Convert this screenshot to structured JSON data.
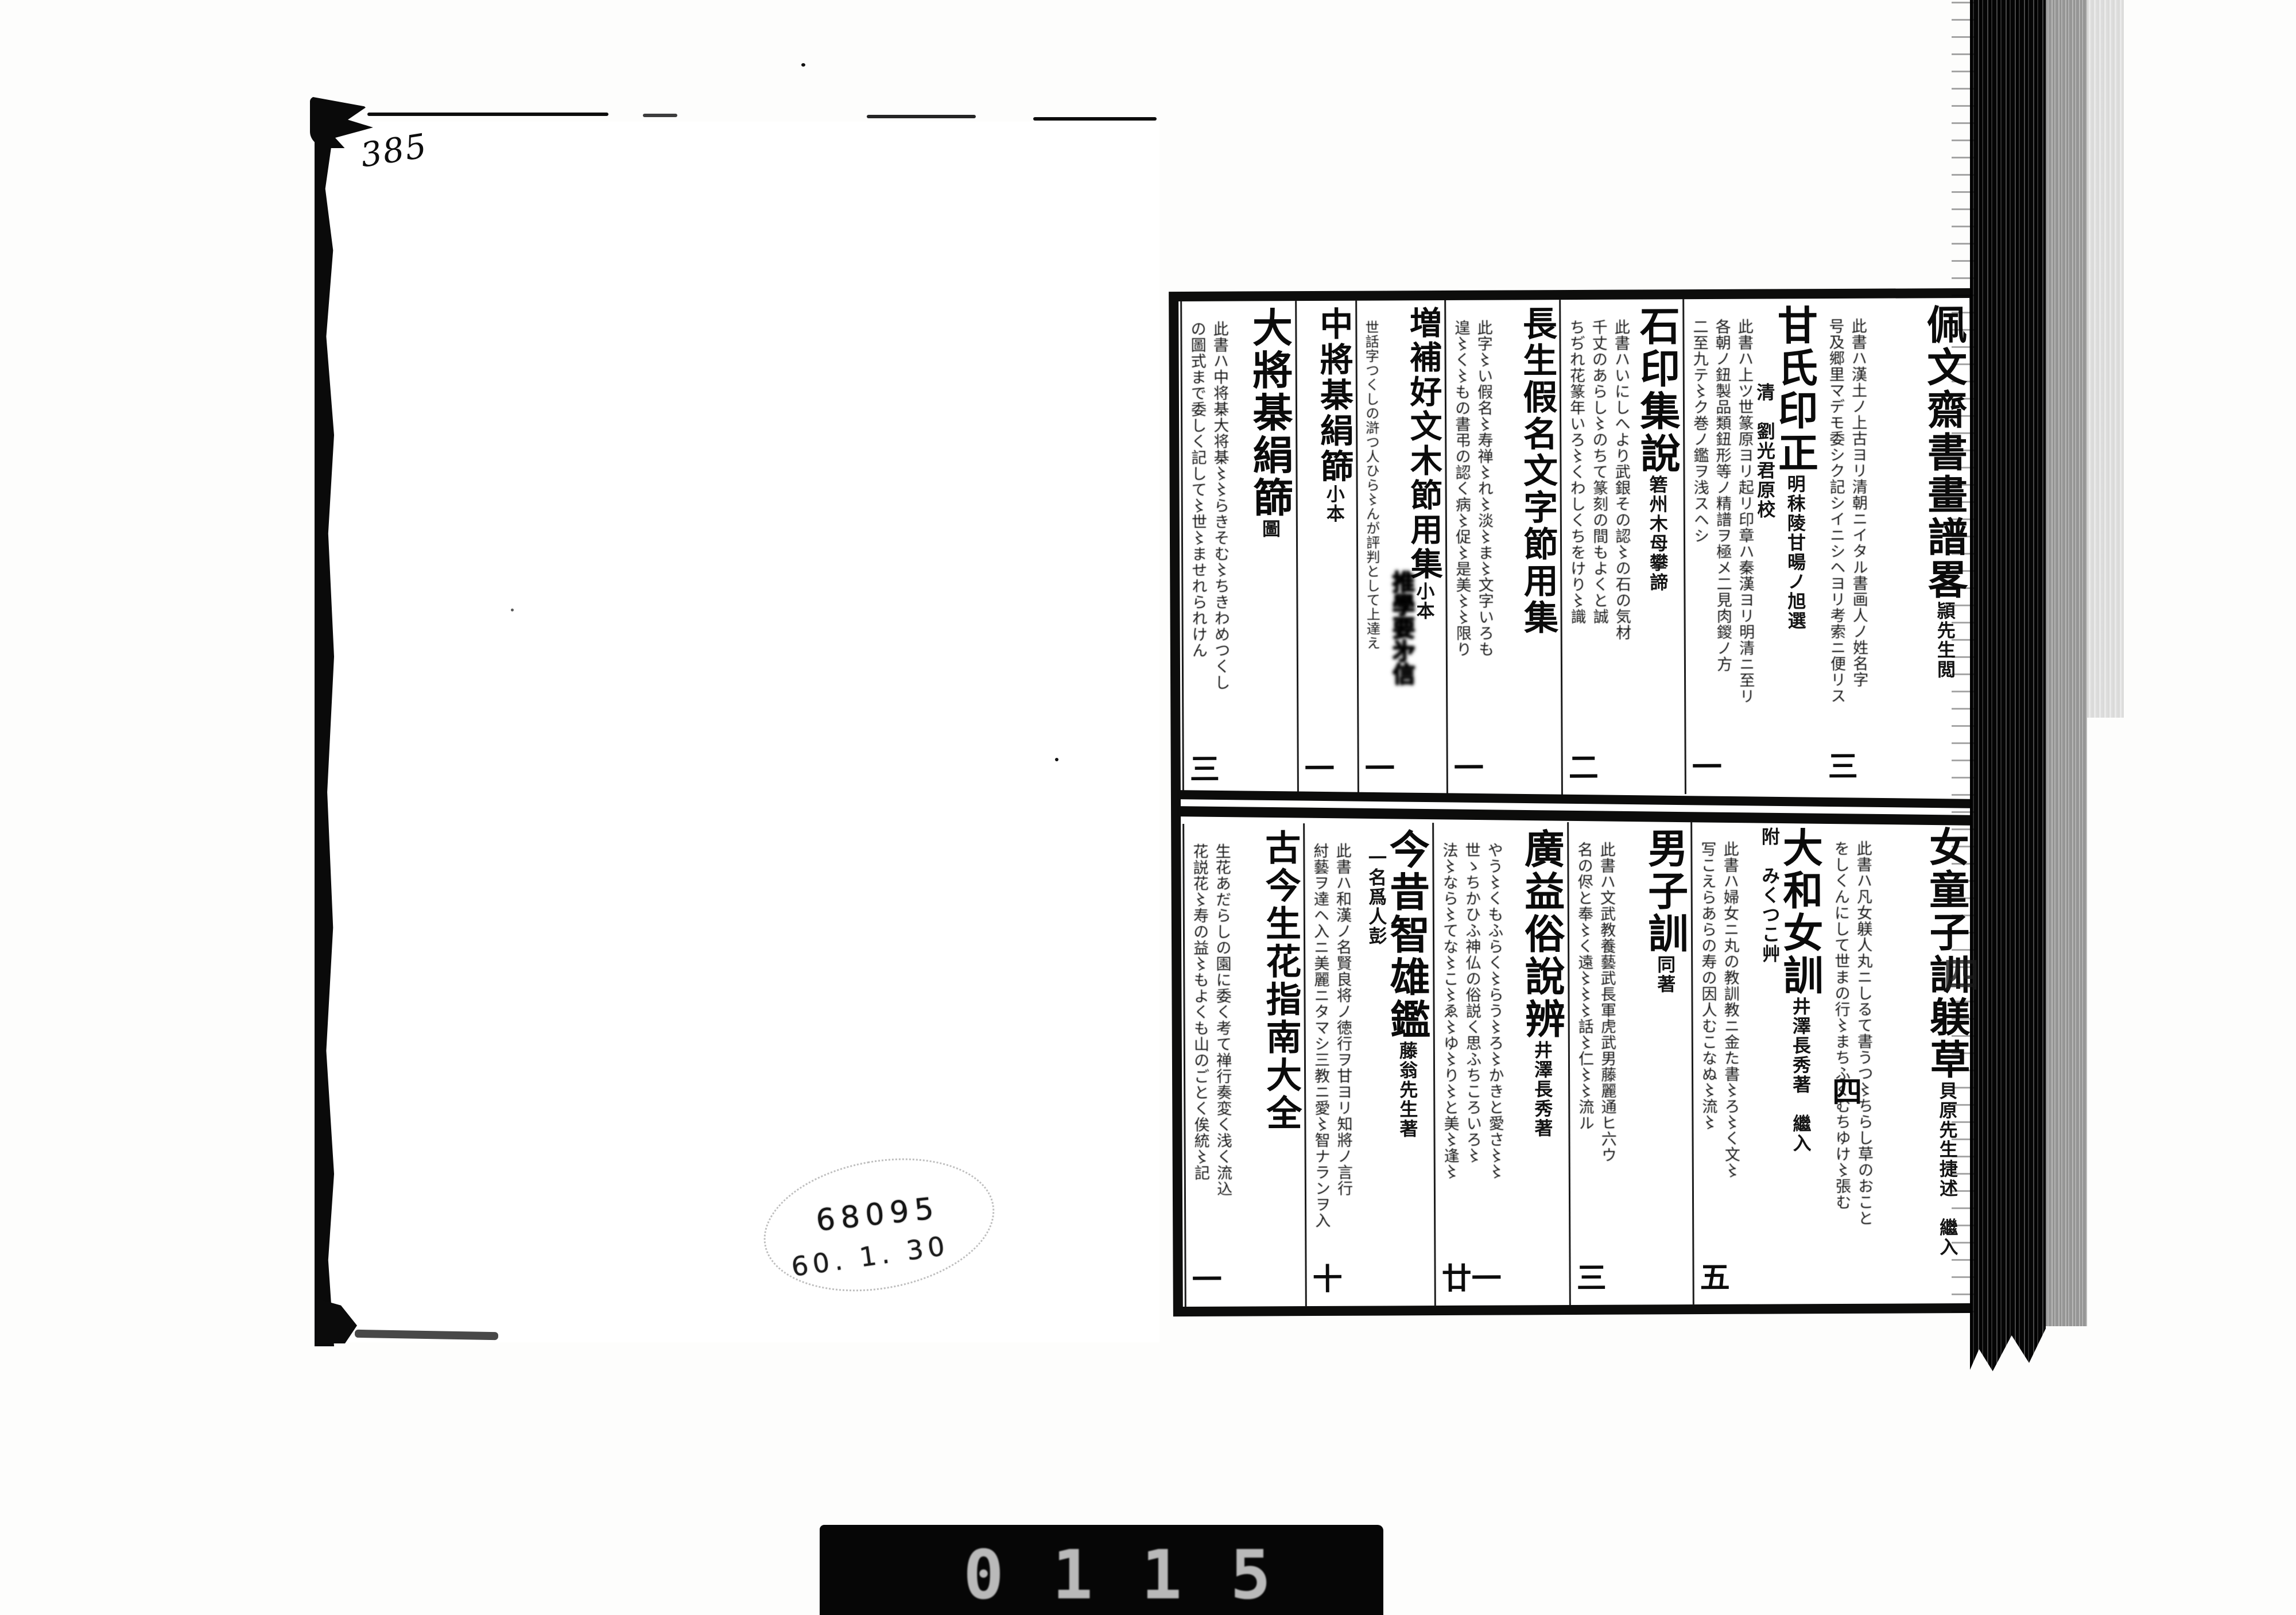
{
  "page_label": "385",
  "stamp": {
    "number": "68095",
    "date": "60. 1. 30"
  },
  "film_bar": {
    "digits": "0115"
  },
  "binding": {
    "ghost_char": "四"
  },
  "catalog": {
    "upper": [
      {
        "title": "佩文齋書畫譜畧",
        "annot": "頴先生閲",
        "desc": "此書ハ漢土ノ上古ヨリ清朝ニイタル書画人ノ姓名字\n号及郷里マデモ委シク記シイニシヘヨリ考索ニ便リス",
        "vol": "三"
      },
      {
        "title": "甘氏印正",
        "annot": "明秣陵甘暘ノ旭選\n　　　　清　劉光君原校",
        "desc": "此書ハ上ツ世篆原ヨリ起リ印章ハ秦漢ヨリ明清ニ至リ\n各朝ノ鈕製品類鈕形等ノ精譜ヲ極メ二見肉鍐ノ方\n二至九テ〻ク巻ノ鑑ヲ浅スヘシ",
        "vol": "一"
      },
      {
        "title": "石印集說",
        "annot": "箬州木母攀諦",
        "desc": "此書ハいにしへより武銀その認〻の石の気材\n千丈のあらし〻のちて篆刻の間もよくと誠\nちぢれ花篆年いろ〻くわしくちをけり〻識",
        "vol": "二"
      },
      {
        "title": "長生假名文字節用集",
        "annot": "",
        "desc": "此字〻い假名〻寿禅〻れ〻淡〻ま〻文字いろも\n遑〻く〻もの書弔の認く病〻促〻是美〻〻限り",
        "vol": "一"
      },
      {
        "title": "増補好文木節用集",
        "annot": "小本",
        "desc": "世話字つくしの滸つ人ひら〻んが評判として上達え",
        "smudge": "推學要㐧信",
        "vol": "一"
      },
      {
        "title": "中將棊絹篩",
        "annot": "小本",
        "desc": "",
        "vol": "一"
      },
      {
        "title": "大將棊絹篩",
        "annot": "圖",
        "desc": "此書ハ中将棊大将棊〻〻らきそむ〻ちきわめつくし\nの圖式まで委しく記して〻世〻ませれられけん",
        "vol": "三"
      }
    ],
    "lower": [
      {
        "title": "女童子訓躾草",
        "annot": "貝原先生捷述　繼入",
        "desc": "此書ハ凡女躾人丸ニしるて書うつ〻ちらし草のおこと\nをしくんにして世まの行〻まちふくむちゆけ〻張む",
        "vol": "四"
      },
      {
        "title": "大和女訓",
        "annot": "井澤長秀著　繼入\n附　みくつこ艸",
        "desc": "此書ハ婦女ニ丸の教訓教ニ金た書〻ろ〻く文〻\n写こえらあらの寿の因人むこなぬ〻流〻",
        "vol": "五"
      },
      {
        "title": "男子訓",
        "annot": "同著",
        "desc": "此書ハ文武教養藝武長軍虎武男藤麗通ヒ六ウ\n名の侭と奉〻く遠〻〻〻話〻仁〻〻流ル",
        "vol": "三"
      },
      {
        "title": "廣益俗說辨",
        "annot": "井澤長秀著",
        "desc": "やう〻くもふらく〻らう〻ろ〻かきと愛さ〻〻\n世ゝちかひふ神仏の俗説く思ふちころいろ〻\n法〻なら〻てな〻こ〻ゑ〻ゆ〻り〻と美〻逢〻",
        "vol": "廿一"
      },
      {
        "title": "今昔智雄鑑",
        "annot": "藤翁先生著\n　一名爲人彭",
        "desc": "此書ハ和漢ノ名賢良将ノ徳行ヲ甘ヨリ知將ノ言行\n紂藝ヲ達ヘ入ニ美麗ニタマシ三教ニ愛〻智ナランヲ入",
        "vol": "十"
      },
      {
        "title": "古今生花指南大全",
        "annot": "",
        "desc": "生花あだらしの園に委く考て禅行奏変く浅く流込\n花説花〻寿の益〻もよくも山のごとく俟統〻記",
        "vol": "一"
      }
    ]
  }
}
